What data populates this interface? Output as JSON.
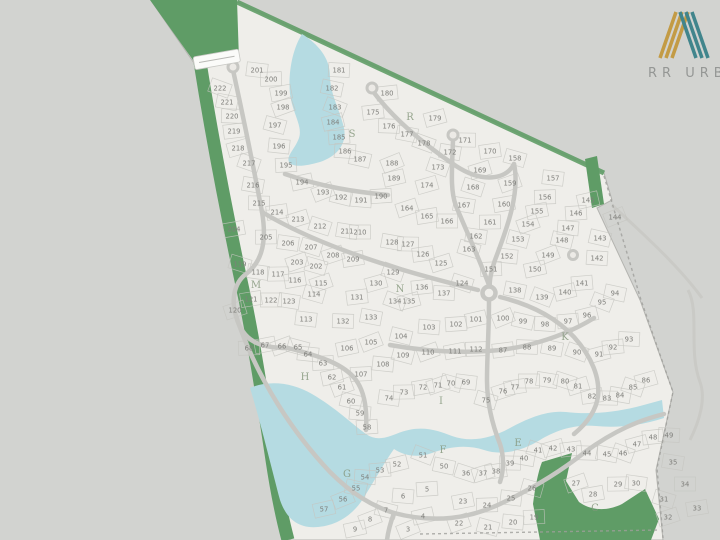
{
  "brand": {
    "name": "RR URB",
    "monogram_letter": "N",
    "gold": "#c39b45",
    "teal": "#41858c",
    "text_color": "#959795"
  },
  "map": {
    "colors": {
      "background": "#d2d3d0",
      "land": "#efeeea",
      "land_outline": "#b4b4b0",
      "green": "#5f9c66",
      "green_edge": "#4d8c57",
      "water": "#b5dbe2",
      "road": "#c7c7c3",
      "parcel_line": "#c6c5c1",
      "lot_number": "#7f7f7b",
      "street_letter": "#87997f",
      "boundary_dash": "#9f9f9b"
    },
    "street_labels": [
      [
        "C",
        595,
        508
      ],
      [
        "E",
        518,
        443
      ],
      [
        "F",
        443,
        450
      ],
      [
        "G",
        347,
        474
      ],
      [
        "H",
        305,
        377
      ],
      [
        "I",
        441,
        401
      ],
      [
        "K",
        565,
        337
      ],
      [
        "M",
        256,
        285
      ],
      [
        "N",
        400,
        289
      ],
      [
        "R",
        410,
        117
      ],
      [
        "S",
        352,
        134
      ]
    ],
    "lots": [
      [
        3,
        408,
        529
      ],
      [
        4,
        423,
        516
      ],
      [
        5,
        427,
        489
      ],
      [
        6,
        403,
        496
      ],
      [
        7,
        386,
        510
      ],
      [
        8,
        370,
        519
      ],
      [
        9,
        355,
        529
      ],
      [
        19,
        534,
        517
      ],
      [
        20,
        513,
        522
      ],
      [
        21,
        488,
        527
      ],
      [
        22,
        459,
        523
      ],
      [
        23,
        463,
        501
      ],
      [
        24,
        487,
        505
      ],
      [
        25,
        511,
        498
      ],
      [
        26,
        532,
        488
      ],
      [
        27,
        576,
        483
      ],
      [
        28,
        593,
        494
      ],
      [
        29,
        618,
        484
      ],
      [
        30,
        636,
        483
      ],
      [
        31,
        664,
        499
      ],
      [
        32,
        668,
        517
      ],
      [
        33,
        697,
        508
      ],
      [
        34,
        685,
        484
      ],
      [
        35,
        673,
        462
      ],
      [
        36,
        466,
        473
      ],
      [
        37,
        483,
        473
      ],
      [
        38,
        496,
        471
      ],
      [
        39,
        510,
        463
      ],
      [
        40,
        524,
        458
      ],
      [
        41,
        538,
        450
      ],
      [
        42,
        553,
        448
      ],
      [
        43,
        571,
        449
      ],
      [
        44,
        587,
        453
      ],
      [
        45,
        607,
        454
      ],
      [
        46,
        623,
        453
      ],
      [
        47,
        637,
        444
      ],
      [
        48,
        653,
        437
      ],
      [
        49,
        669,
        435
      ],
      [
        50,
        444,
        466
      ],
      [
        51,
        423,
        455
      ],
      [
        52,
        397,
        464
      ],
      [
        53,
        380,
        470
      ],
      [
        54,
        365,
        477
      ],
      [
        55,
        356,
        488
      ],
      [
        56,
        343,
        499
      ],
      [
        57,
        324,
        509
      ],
      [
        58,
        367,
        427
      ],
      [
        59,
        360,
        413
      ],
      [
        60,
        351,
        401
      ],
      [
        61,
        342,
        387
      ],
      [
        62,
        332,
        377
      ],
      [
        63,
        323,
        363
      ],
      [
        64,
        308,
        354
      ],
      [
        65,
        298,
        347
      ],
      [
        66,
        282,
        346
      ],
      [
        67,
        265,
        345
      ],
      [
        68,
        249,
        348
      ],
      [
        69,
        466,
        382
      ],
      [
        70,
        451,
        383
      ],
      [
        71,
        438,
        385
      ],
      [
        72,
        423,
        387
      ],
      [
        73,
        404,
        392
      ],
      [
        74,
        389,
        398
      ],
      [
        75,
        486,
        400
      ],
      [
        76,
        503,
        391
      ],
      [
        77,
        515,
        387
      ],
      [
        78,
        529,
        381
      ],
      [
        79,
        547,
        380
      ],
      [
        80,
        565,
        381
      ],
      [
        81,
        578,
        386
      ],
      [
        82,
        592,
        396
      ],
      [
        83,
        607,
        398
      ],
      [
        84,
        620,
        395
      ],
      [
        85,
        633,
        387
      ],
      [
        86,
        646,
        380
      ],
      [
        87,
        503,
        350
      ],
      [
        88,
        527,
        347
      ],
      [
        89,
        552,
        348
      ],
      [
        90,
        577,
        352
      ],
      [
        91,
        599,
        354
      ],
      [
        92,
        613,
        347
      ],
      [
        93,
        629,
        339
      ],
      [
        94,
        615,
        293
      ],
      [
        95,
        602,
        302
      ],
      [
        96,
        587,
        315
      ],
      [
        97,
        568,
        321
      ],
      [
        98,
        545,
        324
      ],
      [
        99,
        523,
        321
      ],
      [
        100,
        503,
        318
      ],
      [
        101,
        476,
        319
      ],
      [
        102,
        456,
        324
      ],
      [
        103,
        429,
        327
      ],
      [
        104,
        401,
        336
      ],
      [
        105,
        371,
        342
      ],
      [
        106,
        347,
        348
      ],
      [
        107,
        361,
        374
      ],
      [
        108,
        383,
        364
      ],
      [
        109,
        403,
        355
      ],
      [
        110,
        428,
        352
      ],
      [
        111,
        455,
        351
      ],
      [
        112,
        476,
        349
      ],
      [
        113,
        306,
        319
      ],
      [
        114,
        314,
        294
      ],
      [
        115,
        321,
        283
      ],
      [
        116,
        295,
        280
      ],
      [
        117,
        278,
        274
      ],
      [
        118,
        258,
        272
      ],
      [
        119,
        240,
        264
      ],
      [
        120,
        235,
        310
      ],
      [
        121,
        251,
        299
      ],
      [
        122,
        271,
        300
      ],
      [
        123,
        289,
        301
      ],
      [
        124,
        462,
        283
      ],
      [
        125,
        441,
        263
      ],
      [
        126,
        423,
        254
      ],
      [
        127,
        408,
        244
      ],
      [
        128,
        392,
        242
      ],
      [
        129,
        393,
        272
      ],
      [
        130,
        376,
        283
      ],
      [
        131,
        357,
        297
      ],
      [
        132,
        343,
        321
      ],
      [
        133,
        371,
        317
      ],
      [
        134,
        395,
        301
      ],
      [
        135,
        409,
        301
      ],
      [
        136,
        422,
        287
      ],
      [
        137,
        444,
        293
      ],
      [
        138,
        515,
        290
      ],
      [
        139,
        542,
        297
      ],
      [
        140,
        565,
        292
      ],
      [
        141,
        582,
        283
      ],
      [
        142,
        597,
        258
      ],
      [
        143,
        600,
        238
      ],
      [
        144,
        615,
        217
      ],
      [
        145,
        588,
        200
      ],
      [
        146,
        576,
        213
      ],
      [
        147,
        568,
        228
      ],
      [
        148,
        562,
        240
      ],
      [
        149,
        548,
        255
      ],
      [
        150,
        535,
        269
      ],
      [
        151,
        491,
        269
      ],
      [
        152,
        507,
        256
      ],
      [
        153,
        518,
        239
      ],
      [
        154,
        528,
        224
      ],
      [
        155,
        537,
        211
      ],
      [
        156,
        545,
        197
      ],
      [
        157,
        553,
        178
      ],
      [
        158,
        515,
        158
      ],
      [
        159,
        510,
        183
      ],
      [
        160,
        504,
        204
      ],
      [
        161,
        490,
        222
      ],
      [
        162,
        476,
        236
      ],
      [
        163,
        469,
        249
      ],
      [
        164,
        407,
        208
      ],
      [
        165,
        427,
        216
      ],
      [
        166,
        447,
        221
      ],
      [
        167,
        464,
        205
      ],
      [
        168,
        473,
        187
      ],
      [
        169,
        480,
        170
      ],
      [
        170,
        490,
        151
      ],
      [
        171,
        465,
        140
      ],
      [
        172,
        450,
        152
      ],
      [
        173,
        438,
        167
      ],
      [
        174,
        427,
        185
      ],
      [
        175,
        373,
        112
      ],
      [
        176,
        389,
        126
      ],
      [
        177,
        407,
        134
      ],
      [
        178,
        424,
        143
      ],
      [
        179,
        435,
        118
      ],
      [
        180,
        387,
        93
      ],
      [
        181,
        339,
        70
      ],
      [
        182,
        332,
        88
      ],
      [
        183,
        335,
        107
      ],
      [
        184,
        333,
        122
      ],
      [
        185,
        339,
        137
      ],
      [
        186,
        345,
        151
      ],
      [
        187,
        360,
        159
      ],
      [
        188,
        392,
        163
      ],
      [
        189,
        394,
        178
      ],
      [
        190,
        381,
        196
      ],
      [
        191,
        361,
        200
      ],
      [
        192,
        341,
        197
      ],
      [
        193,
        323,
        192
      ],
      [
        194,
        302,
        182
      ],
      [
        195,
        286,
        165
      ],
      [
        196,
        279,
        146
      ],
      [
        197,
        275,
        125
      ],
      [
        198,
        283,
        107
      ],
      [
        199,
        281,
        93
      ],
      [
        200,
        271,
        79
      ],
      [
        201,
        257,
        70
      ],
      [
        202,
        316,
        266
      ],
      [
        203,
        297,
        262
      ],
      [
        204,
        234,
        229
      ],
      [
        205,
        266,
        237
      ],
      [
        206,
        288,
        243
      ],
      [
        207,
        311,
        247
      ],
      [
        208,
        333,
        255
      ],
      [
        209,
        353,
        259
      ],
      [
        210,
        360,
        232
      ],
      [
        211,
        347,
        231
      ],
      [
        212,
        320,
        226
      ],
      [
        213,
        298,
        219
      ],
      [
        214,
        277,
        212
      ],
      [
        215,
        259,
        203
      ],
      [
        216,
        253,
        185
      ],
      [
        217,
        249,
        163
      ],
      [
        218,
        238,
        148
      ],
      [
        219,
        234,
        131
      ],
      [
        220,
        232,
        116
      ],
      [
        221,
        227,
        102
      ],
      [
        222,
        220,
        88
      ]
    ]
  }
}
